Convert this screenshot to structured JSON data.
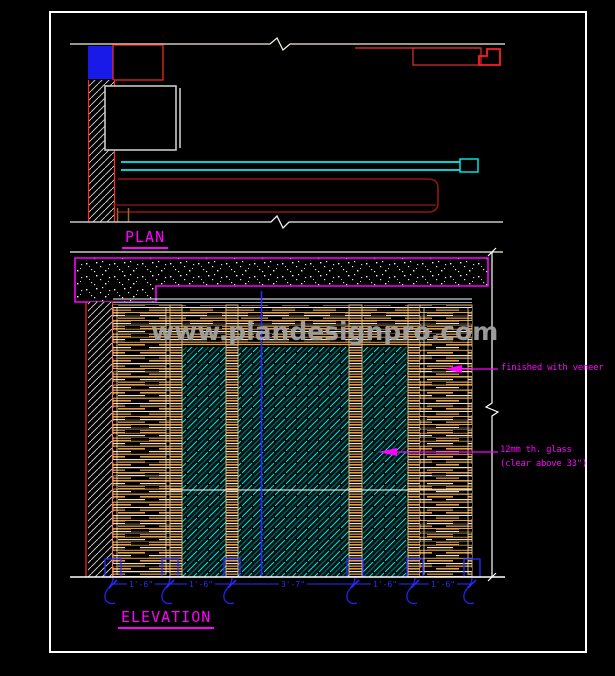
{
  "watermark": {
    "text": "www.plandesignpro.com"
  },
  "plan": {
    "label": "PLAN"
  },
  "elevation": {
    "label": "ELEVATION",
    "annotations": {
      "veneer": "finished with veneer",
      "glass_line1": "12mm th. glass",
      "glass_line2": "(clear above 33\")"
    },
    "dimensions": [
      "1'-6\"",
      "1'-6\"",
      "3'-7\"",
      "1'-6\"",
      "1'-6\""
    ]
  },
  "colors": {
    "background": "#000000",
    "frame": "#FFFFFF",
    "label_magenta": "#FF00FF",
    "dimension_blue": "#2B2BFF",
    "glass_cyan": "#00E8E8",
    "wood_tan": "#DFA04A",
    "line_red": "#FF2A2A",
    "dark_red": "#8F1616",
    "fill_blue": "#1A1AE8",
    "watermark_gray": "#A2A2A2"
  }
}
